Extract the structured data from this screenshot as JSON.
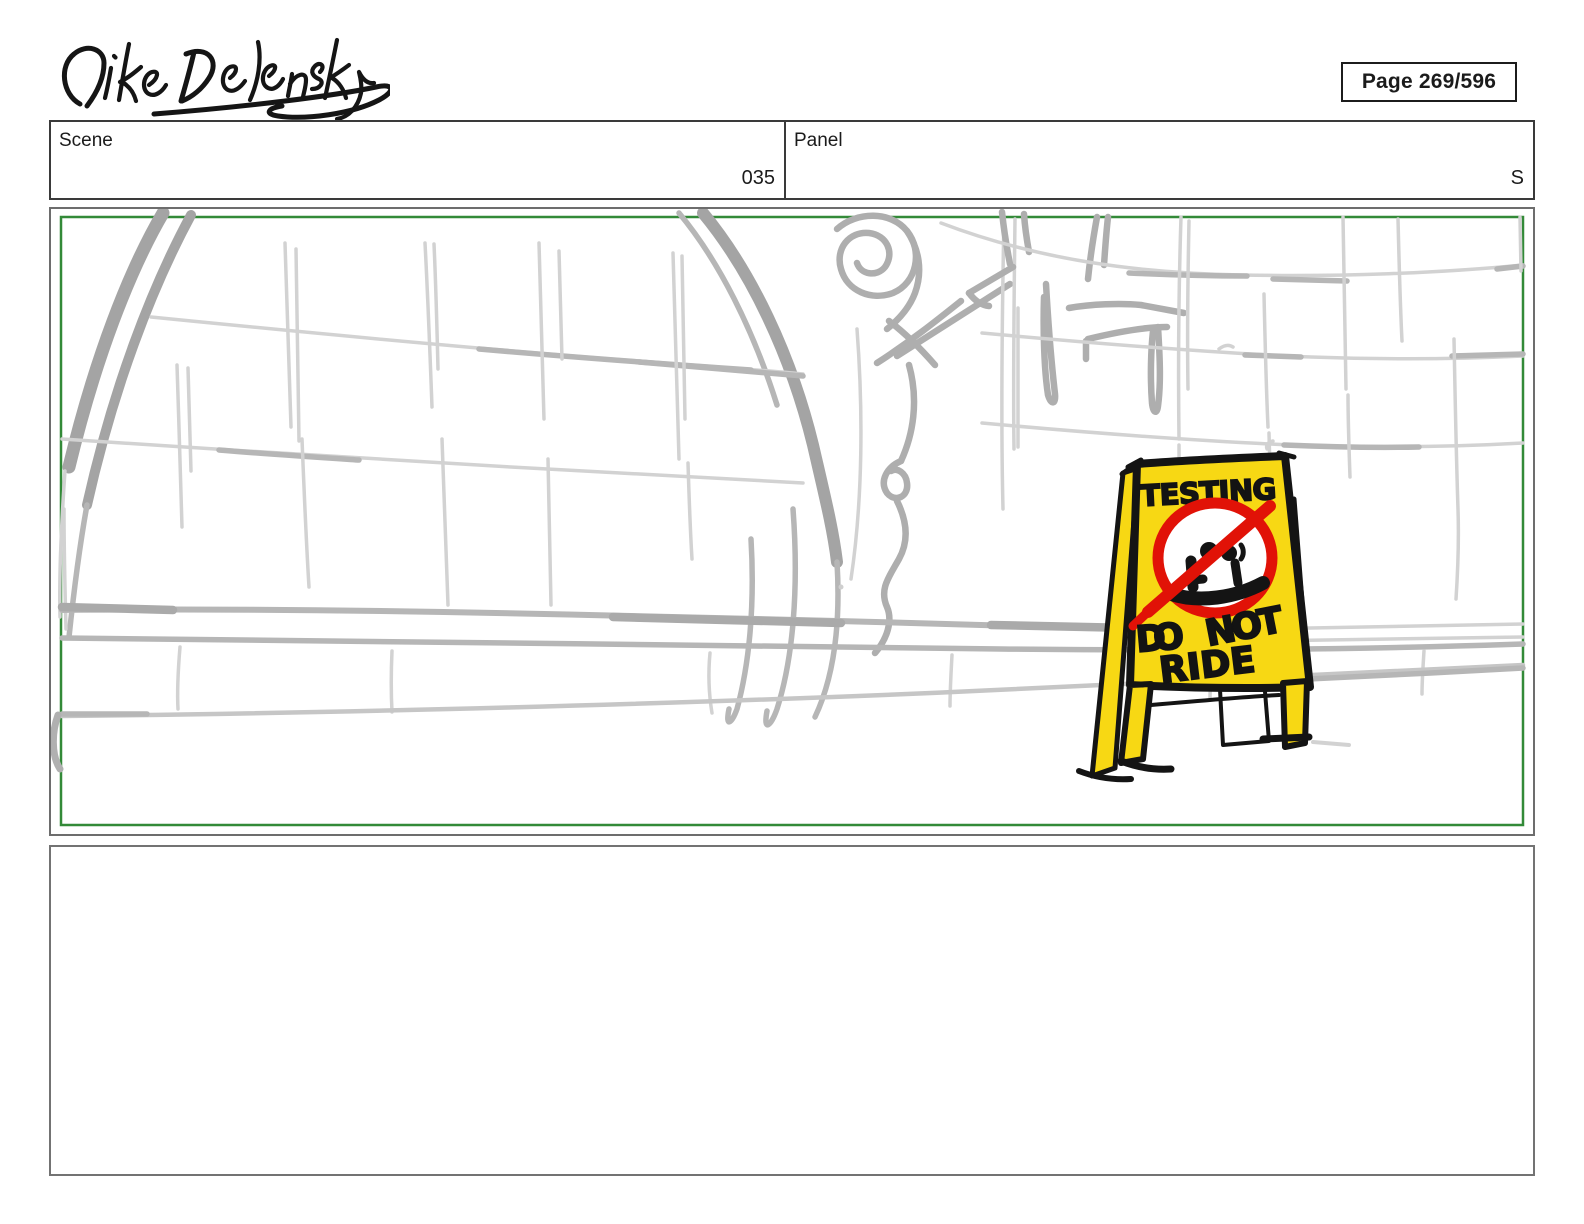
{
  "page": {
    "artist_signature": "Mike Delensky",
    "page_label": "Page 269/596"
  },
  "header_row": {
    "scene_label": "Scene",
    "scene_value": "035",
    "panel_label": "Panel",
    "panel_value": "S"
  },
  "storyboard": {
    "frame_border_color": "#338a38",
    "sign": {
      "word_testing": "TESTING",
      "word_do": "DO",
      "word_not": "NOT",
      "word_ride": "RIDE",
      "colors": {
        "yellow": "#f7d814",
        "red": "#e11207",
        "black": "#141414"
      }
    }
  },
  "notes_box": {
    "content": ""
  }
}
